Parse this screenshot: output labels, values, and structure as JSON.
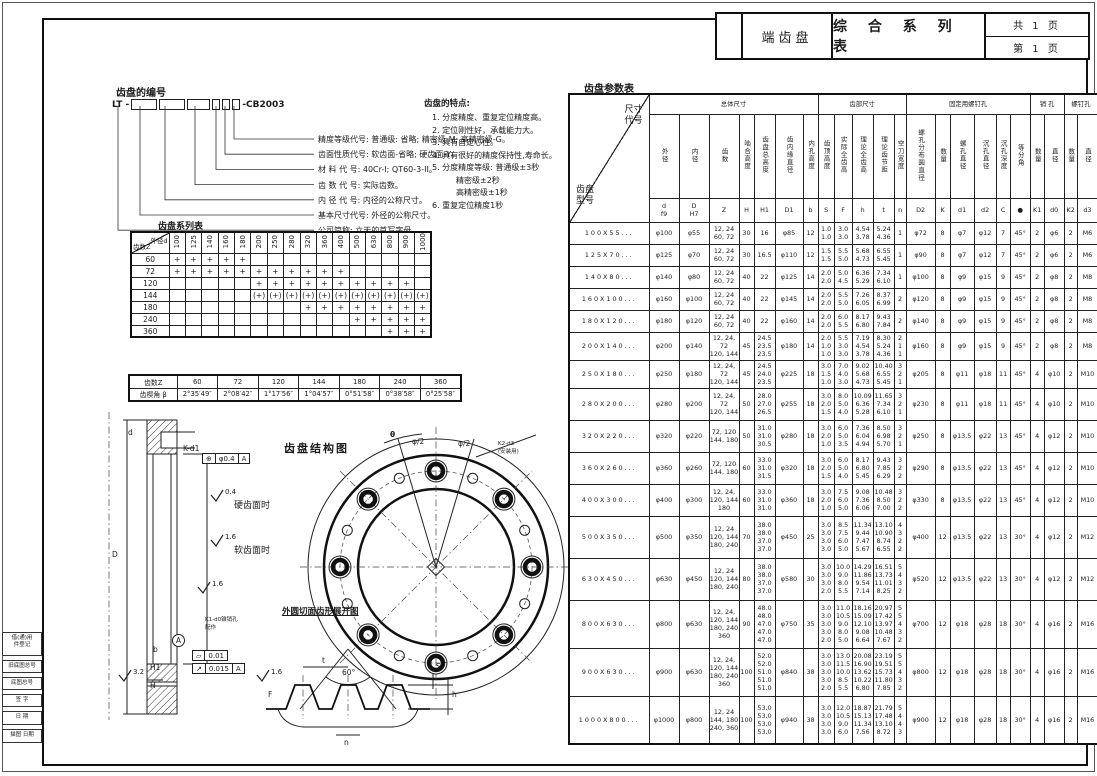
{
  "title_block": {
    "part_name": "端齿盘",
    "table_title": "综 合 系 列 表",
    "pages_total": "共  1  页",
    "page_number": "第  1  页"
  },
  "numbering": {
    "title": "齿盘的编号",
    "code_prefix": "LT -",
    "code_suffix": "-CB2003",
    "callouts": [
      "精度等级代号: 普通级: 省略; 精密级-M; 高精密级-G。",
      "齿面性质代号: 软齿面-省略; 硬齿面-Y。",
      "材 料 代 号: 40Cr-I; QT60-3-II。",
      "齿 数 代 号: 实际齿数。",
      "内 径 代 号: 内径的公称尺寸。",
      "基本尺寸代号: 外径的公称尺寸。",
      "公司简称: 立天的首写字母。"
    ]
  },
  "features": {
    "title": "齿盘的特点:",
    "items": [
      "1. 分度精度、重复定位精度高。",
      "2. 定位刚性好，承载能力大。",
      "3. 具有自定心性。",
      "4. 具有很好的精度保持性,寿命长。",
      "5. 分度精度等级: 普通级±3秒\n　　　精密级±2秒\n　　　高精密级±1秒",
      "6. 重复定位精度1秒"
    ]
  },
  "series_table": {
    "title": "齿盘系列表",
    "corner_top": "外径d",
    "corner_bottom": "齿数Z",
    "columns": [
      "100",
      "125",
      "140",
      "160",
      "180",
      "200",
      "250",
      "280",
      "320",
      "360",
      "400",
      "500",
      "630",
      "800",
      "900",
      "1000"
    ],
    "rows": [
      {
        "z": "60",
        "marks": [
          "+",
          "+",
          "+",
          "+",
          "+",
          "",
          "",
          "",
          "",
          "",
          "",
          "",
          "",
          "",
          "",
          ""
        ]
      },
      {
        "z": "72",
        "marks": [
          "+",
          "+",
          "+",
          "+",
          "+",
          "+",
          "+",
          "+",
          "+",
          "+",
          "+",
          "",
          "",
          "",
          "",
          ""
        ]
      },
      {
        "z": "120",
        "marks": [
          "",
          "",
          "",
          "",
          "",
          "+",
          "+",
          "+",
          "+",
          "+",
          "+",
          "+",
          "+",
          "+",
          "+",
          ""
        ]
      },
      {
        "z": "144",
        "marks": [
          "",
          "",
          "",
          "",
          "",
          "(+)",
          "(+)",
          "(+)",
          "(+)",
          "(+)",
          "(+)",
          "(+)",
          "(+)",
          "(+)",
          "(+)",
          "(+)"
        ]
      },
      {
        "z": "180",
        "marks": [
          "",
          "",
          "",
          "",
          "",
          "",
          "",
          "",
          "+",
          "+",
          "+",
          "+",
          "+",
          "+",
          "+",
          "+"
        ]
      },
      {
        "z": "240",
        "marks": [
          "",
          "",
          "",
          "",
          "",
          "",
          "",
          "",
          "",
          "",
          "",
          "+",
          "+",
          "+",
          "+",
          "+"
        ]
      },
      {
        "z": "360",
        "marks": [
          "",
          "",
          "",
          "",
          "",
          "",
          "",
          "",
          "",
          "",
          "",
          "",
          "",
          "+",
          "+",
          "+"
        ]
      }
    ]
  },
  "angle_table": {
    "row1_label": "齿数Z",
    "row2_label": "齿楔角 β",
    "z_values": [
      "60",
      "72",
      "120",
      "144",
      "180",
      "240",
      "360"
    ],
    "beta_values": [
      "2°35′49″",
      "2°08′42″",
      "1°17′56″",
      "1°04′57″",
      "0°51′58″",
      "0°38′58″",
      "0°25′58″"
    ]
  },
  "param_table": {
    "title": "齿盘参数表",
    "corner_top": "尺寸\n代号",
    "corner_bottom": "齿盘\n型号",
    "groups": [
      {
        "label": "总体尺寸",
        "span": 7
      },
      {
        "label": "齿部尺寸",
        "span": 5
      },
      {
        "label": "固定用螺钉孔",
        "span": 6
      },
      {
        "label": "销  孔",
        "span": 2
      },
      {
        "label": "螺钉孔",
        "span": 2
      }
    ],
    "columns": [
      {
        "name": "外径",
        "sym": "d\nf9"
      },
      {
        "name": "内径",
        "sym": "D\nH7"
      },
      {
        "name": "齿数",
        "sym": "Z"
      },
      {
        "name": "啮合高度",
        "sym": "H"
      },
      {
        "name": "齿盘总高度",
        "sym": "H1"
      },
      {
        "name": "齿内缘直径",
        "sym": "D1"
      },
      {
        "name": "内孔高度",
        "sym": "b"
      },
      {
        "name": "齿顶高度",
        "sym": "S"
      },
      {
        "name": "实际全齿高",
        "sym": "F"
      },
      {
        "name": "理论全齿高",
        "sym": "h"
      },
      {
        "name": "理论齿节距",
        "sym": "t"
      },
      {
        "name": "空刀宽度",
        "sym": "n"
      },
      {
        "name": "螺孔分布圆直径",
        "sym": "D2"
      },
      {
        "name": "数量",
        "sym": "K"
      },
      {
        "name": "螺孔直径",
        "sym": "d1"
      },
      {
        "name": "沉孔直径",
        "sym": "d2"
      },
      {
        "name": "沉孔深度",
        "sym": "C"
      },
      {
        "name": "等分角",
        "sym": "●"
      },
      {
        "name": "数量",
        "sym": "K1"
      },
      {
        "name": "直径",
        "sym": "d0"
      },
      {
        "name": "数量",
        "sym": "K2"
      },
      {
        "name": "直径",
        "sym": "d3"
      }
    ],
    "rows": [
      {
        "model": "100X55...",
        "values": [
          "φ100",
          "φ55",
          "12, 24\n60, 72",
          "30",
          "16",
          "φ85",
          "12",
          "1.0\n1.0",
          "3.0\n3.0",
          "4.54\n3.78",
          "5.24\n4.36",
          "1",
          "φ72",
          "8",
          "φ7",
          "φ12",
          "7",
          "45°",
          "2",
          "φ6",
          "2",
          "M6"
        ]
      },
      {
        "model": "125X70...",
        "values": [
          "φ125",
          "φ70",
          "12, 24\n60, 72",
          "30",
          "16.5",
          "φ110",
          "12",
          "1.5\n1.5",
          "5.5\n5.0",
          "5.68\n4.73",
          "6.55\n5.45",
          "1",
          "φ90",
          "8",
          "φ7",
          "φ12",
          "7",
          "45°",
          "2",
          "φ6",
          "2",
          "M6"
        ]
      },
      {
        "model": "140X80...",
        "values": [
          "φ140",
          "φ80",
          "12, 24\n60, 72",
          "40",
          "22",
          "φ125",
          "14",
          "2.0\n2.0",
          "5.0\n4.5",
          "6.36\n5.29",
          "7.34\n6.10",
          "1",
          "φ100",
          "8",
          "φ9",
          "φ15",
          "9",
          "45°",
          "2",
          "φ8",
          "2",
          "M8"
        ]
      },
      {
        "model": "160X100...",
        "values": [
          "φ160",
          "φ100",
          "12, 24\n60, 72",
          "40",
          "22",
          "φ145",
          "14",
          "2.0\n2.0",
          "5.5\n5.0",
          "7.26\n6.05",
          "8.37\n6.99",
          "2",
          "φ120",
          "8",
          "φ9",
          "φ15",
          "9",
          "45°",
          "2",
          "φ8",
          "2",
          "M8"
        ]
      },
      {
        "model": "180X120...",
        "values": [
          "φ180",
          "φ120",
          "12, 24\n60, 72",
          "40",
          "22",
          "φ160",
          "14",
          "2.0\n2.0",
          "6.0\n5.5",
          "8.17\n6.80",
          "9.43\n7.84",
          "2",
          "φ140",
          "8",
          "φ9",
          "φ15",
          "9",
          "45°",
          "2",
          "φ8",
          "2",
          "M8"
        ]
      },
      {
        "model": "200X140...",
        "values": [
          "φ200",
          "φ140",
          "12, 24, 72\n120, 144",
          "45",
          "24.5\n23.5\n23.5",
          "φ180",
          "14",
          "2.0\n1.0\n1.0",
          "5.5\n3.0\n3.0",
          "7.19\n4.54\n3.78",
          "8.30\n5.24\n4.36",
          "2\n1\n1",
          "φ160",
          "8",
          "φ9",
          "φ15",
          "9",
          "45°",
          "2",
          "φ8",
          "2",
          "M8"
        ]
      },
      {
        "model": "250X180...",
        "values": [
          "φ250",
          "φ180",
          "12, 24, 72\n120, 144",
          "45",
          "24.5\n24.0\n23.5",
          "φ225",
          "18",
          "3.0\n1.5\n1.0",
          "7.0\n4.0\n3.0",
          "9.02\n5.68\n4.73",
          "10.40\n6.55\n5.45",
          "3\n2\n1",
          "φ205",
          "8",
          "φ11",
          "φ18",
          "11",
          "45°",
          "4",
          "φ10",
          "2",
          "M10"
        ]
      },
      {
        "model": "280X200...",
        "values": [
          "φ280",
          "φ200",
          "12, 24, 72\n120, 144",
          "50",
          "28.0\n27.0\n26.5",
          "φ255",
          "18",
          "3.0\n2.0\n1.5",
          "8.0\n5.0\n4.0",
          "10.09\n6.36\n5.28",
          "11.65\n7.34\n6.10",
          "3\n2\n1",
          "φ230",
          "8",
          "φ11",
          "φ18",
          "11",
          "45°",
          "4",
          "φ10",
          "2",
          "M10"
        ]
      },
      {
        "model": "320X220...",
        "values": [
          "φ320",
          "φ220",
          "72, 120\n144, 180",
          "50",
          "31.0\n31.0\n30.5",
          "φ280",
          "18",
          "3.0\n2.0\n1.0",
          "6.0\n5.0\n3.5",
          "7.36\n6.04\n4.94",
          "8.50\n6.98\n5.70",
          "3\n2\n1",
          "φ250",
          "8",
          "φ13.5",
          "φ22",
          "13",
          "45°",
          "4",
          "φ12",
          "2",
          "M10"
        ]
      },
      {
        "model": "360X260...",
        "values": [
          "φ360",
          "φ260",
          "72, 120\n144, 180",
          "60",
          "33.0\n31.0\n31.5",
          "φ320",
          "18",
          "3.0\n2.0\n1.5",
          "6.0\n5.0\n4.0",
          "8.17\n6.80\n5.45",
          "9.43\n7.85\n6.29",
          "3\n2\n2",
          "φ290",
          "8",
          "φ13.5",
          "φ22",
          "13",
          "45°",
          "4",
          "φ12",
          "2",
          "M10"
        ]
      },
      {
        "model": "400X300...",
        "values": [
          "φ400",
          "φ300",
          "12, 24,\n120, 144\n180",
          "60",
          "33.0\n31.0\n31.0",
          "φ360",
          "18",
          "3.0\n2.0\n1.0",
          "7.5\n6.0\n5.0",
          "9.08\n7.36\n6.06",
          "10.48\n8.50\n7.00",
          "3\n2\n2",
          "φ330",
          "8",
          "φ13.5",
          "φ22",
          "13",
          "45°",
          "4",
          "φ12",
          "2",
          "M10"
        ]
      },
      {
        "model": "500X350...",
        "values": [
          "φ500",
          "φ350",
          "12, 24\n120, 144\n180, 240",
          "70",
          "38.0\n38.0\n37.0\n37.0",
          "φ450",
          "25",
          "3.0\n3.0\n3.0\n3.0",
          "8.5\n7.5\n6.0\n5.0",
          "11.34\n9.44\n7.47\n5.67",
          "13.10\n10.90\n8.74\n6.55",
          "4\n3\n2\n2",
          "φ400",
          "12",
          "φ13.5",
          "φ22",
          "13",
          "30°",
          "4",
          "φ12",
          "2",
          "M12"
        ]
      },
      {
        "model": "630X450...",
        "values": [
          "φ630",
          "φ450",
          "12, 24\n120, 144\n180, 240",
          "80",
          "38.0\n38.0\n37.0\n37.0",
          "φ580",
          "30",
          "3.0\n3.0\n3.0\n2.0",
          "10.0\n9.0\n8.0\n5.5",
          "14.29\n11.86\n9.54\n7.14",
          "16.51\n13.73\n11.01\n8.25",
          "5\n4\n3\n2",
          "φ520",
          "12",
          "φ13.5",
          "φ22",
          "13",
          "30°",
          "4",
          "φ12",
          "2",
          "M12"
        ]
      },
      {
        "model": "800X630...",
        "values": [
          "φ800",
          "φ630",
          "12, 24,\n120, 144\n180, 240\n360",
          "90",
          "48.0\n48.0\n47.0\n47.0\n47.0",
          "φ750",
          "35",
          "3.0\n3.0\n3.0\n3.0\n2.0",
          "11.0\n10.5\n9.0\n8.0\n5.0",
          "18.16\n15.09\n12.10\n9.08\n6.64",
          "20.97\n17.42\n13.97\n10.48\n7.67",
          "5\n5\n4\n3\n2",
          "φ700",
          "12",
          "φ18",
          "φ28",
          "18",
          "30°",
          "4",
          "φ16",
          "2",
          "M16"
        ]
      },
      {
        "model": "900X630...",
        "values": [
          "φ900",
          "φ630",
          "12, 24,\n120, 144\n180, 240\n360",
          "100",
          "52.0\n52.0\n51.0\n51.0\n51.0",
          "φ840",
          "38",
          "3.0\n3.0\n3.0\n3.0\n2.0",
          "13.0\n11.5\n10.0\n8.5\n5.5",
          "20.08\n16.90\n13.62\n10.22\n6.80",
          "23.19\n19.51\n15.73\n11.80\n7.85",
          "5\n5\n4\n3\n2",
          "φ800",
          "12",
          "φ18",
          "φ28",
          "18",
          "30°",
          "4",
          "φ16",
          "2",
          "M16"
        ]
      },
      {
        "model": "1000X800...",
        "values": [
          "φ1000",
          "φ800",
          "12, 24\n144, 180\n240, 360",
          "100",
          "53.0\n53.0\n53.0\n53.0",
          "φ940",
          "38",
          "3.0\n3.0\n3.0\n3.0",
          "12.0\n10.5\n9.0\n6.0",
          "18.87\n15.13\n11.34\n7.56",
          "21.79\n17.48\n13.10\n8.72",
          "5\n4\n4\n3",
          "φ900",
          "12",
          "φ18",
          "φ28",
          "18",
          "30°",
          "4",
          "φ16",
          "2",
          "M16"
        ]
      }
    ]
  },
  "drawings": {
    "section": {
      "callout_bolt": "K-d1",
      "tol_position_sym": "⊕",
      "tol_position_val": "φ0.4",
      "tol_position_datum": "A",
      "rough_hard": "0.4",
      "hard_label": "硬齿面时",
      "rough_soft": "1.6",
      "soft_label": "软齿面时",
      "rough_mid": "1.6",
      "rough_side": "3.2",
      "pin_note": "K1-d0锥销孔\n配作",
      "datum_label": "A",
      "tol_flat_sym": "▱",
      "tol_flat_val": "0.01",
      "tol_runout_sym": "↗",
      "tol_runout_val": "0.015",
      "tol_runout_datum": "A",
      "dim_b": "b",
      "dim_h1": "H1",
      "dim_h": "H",
      "dim_d": "D",
      "dim_d2": "d"
    },
    "structure": {
      "title": "齿盘结构图",
      "theta": "θ",
      "phi_left": "φ/2",
      "phi_right": "φ/2",
      "callout": "K2-d3\n(安装用)"
    },
    "profile": {
      "title": "外圆切面齿形展开图",
      "angle": "60°",
      "dim_t": "t",
      "dim_s": "S",
      "dim_h": "h",
      "dim_f": "F",
      "dim_n": "n",
      "rough": "1.6"
    }
  },
  "margin_boxes": [
    "借(通)用\n件登记",
    "旧底图总号",
    "底图总号",
    "签  字",
    "日  期",
    "描图  日期"
  ]
}
